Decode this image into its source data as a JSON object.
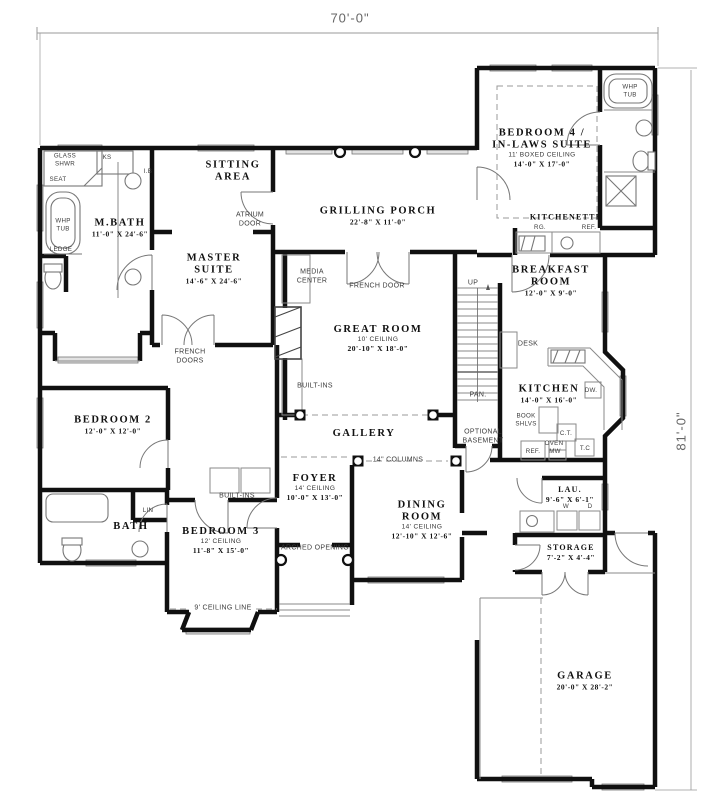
{
  "plan": {
    "width_dim": "70'-0\"",
    "height_dim": "81'-0\""
  },
  "rooms": {
    "sitting_area": {
      "name": "SITTING\nAREA"
    },
    "m_bath": {
      "name": "M.BATH",
      "dims": "11'-0\" X 24'-6\""
    },
    "master_suite": {
      "name": "MASTER\nSUITE",
      "dims": "14'-6\" X 24'-6\""
    },
    "grilling_porch": {
      "name": "GRILLING PORCH",
      "dims": "22'-8\" X 11'-0\""
    },
    "bedroom4": {
      "name": "BEDROOM 4 /\nIN-LAWS SUITE",
      "ceiling": "11' BOXED CEILING",
      "dims": "14'-0\" X 17'-0\""
    },
    "kitchenette": {
      "name": "KITCHENETTE"
    },
    "breakfast_room": {
      "name": "BREAKFAST\nROOM",
      "dims": "12'-0\" X 9'-0\""
    },
    "great_room": {
      "name": "GREAT ROOM",
      "ceiling": "10' CEILING",
      "dims": "20'-10\" X 18'-0\""
    },
    "bedroom2": {
      "name": "BEDROOM 2",
      "dims": "12'-0\" X 12'-0\""
    },
    "gallery": {
      "name": "GALLERY"
    },
    "kitchen": {
      "name": "KITCHEN",
      "dims": "14'-0\" X 16'-0\""
    },
    "foyer": {
      "name": "FOYER",
      "ceiling": "14' CEILING",
      "dims": "10'-0\" X 13'-0\""
    },
    "dining_room": {
      "name": "DINING\nROOM",
      "ceiling": "14' CEILING",
      "dims": "12'-10\" X 12'-6\""
    },
    "bath": {
      "name": "BATH"
    },
    "bedroom3": {
      "name": "BEDROOM 3",
      "ceiling": "12' CEILING",
      "dims": "11'-8\" X 15'-0\""
    },
    "laundry": {
      "name": "LAU.",
      "dims": "9'-6\" X 6'-1\""
    },
    "storage": {
      "name": "STORAGE",
      "dims": "7'-2\" X 4'-4\""
    },
    "garage": {
      "name": "GARAGE",
      "dims": "20'-0\" X 28'-2\""
    }
  },
  "annotations": {
    "glass_shower": "GLASS\nSHWR",
    "seat": "SEAT",
    "ks": "KS",
    "ib": "I.B",
    "whp_tub_master": "WHP\nTUB",
    "ledge": "LEDGE",
    "atrium_door": "ATRIUM\nDOOR",
    "media_center": "MEDIA\nCENTER",
    "french_door": "FRENCH DOOR",
    "french_doors": "FRENCH\nDOORS",
    "built_ins_great_room": "BUILT-INS",
    "built_ins_hall": "BUILT-INS",
    "whp_tub_suite": "WHP\nTUB",
    "rg": "RG.",
    "ref_kitchenette": "REF.",
    "up": "UP",
    "desk": "DESK",
    "pan": "PAN.",
    "optional_basement": "OPTIONAL\nBASEMENT",
    "dw": "DW.",
    "book_shelves": "BOOK\nSHLVS",
    "ct": "C.T.",
    "oven": "OVEN",
    "ref_kitchen": "REF.",
    "mw": "MW",
    "tc": "T.C",
    "columns": "14\" COLUMNS",
    "arched_opening": "ARCHED OPENING",
    "lin": "LIN",
    "washer": "W",
    "dryer": "D",
    "ceiling_line": "9' CEILING LINE"
  },
  "colors": {
    "wall": "#101010",
    "thin_line": "#8a8a8a",
    "window_fill": "#e2e2e2",
    "dimension_text": "#666666",
    "background": "#ffffff"
  }
}
